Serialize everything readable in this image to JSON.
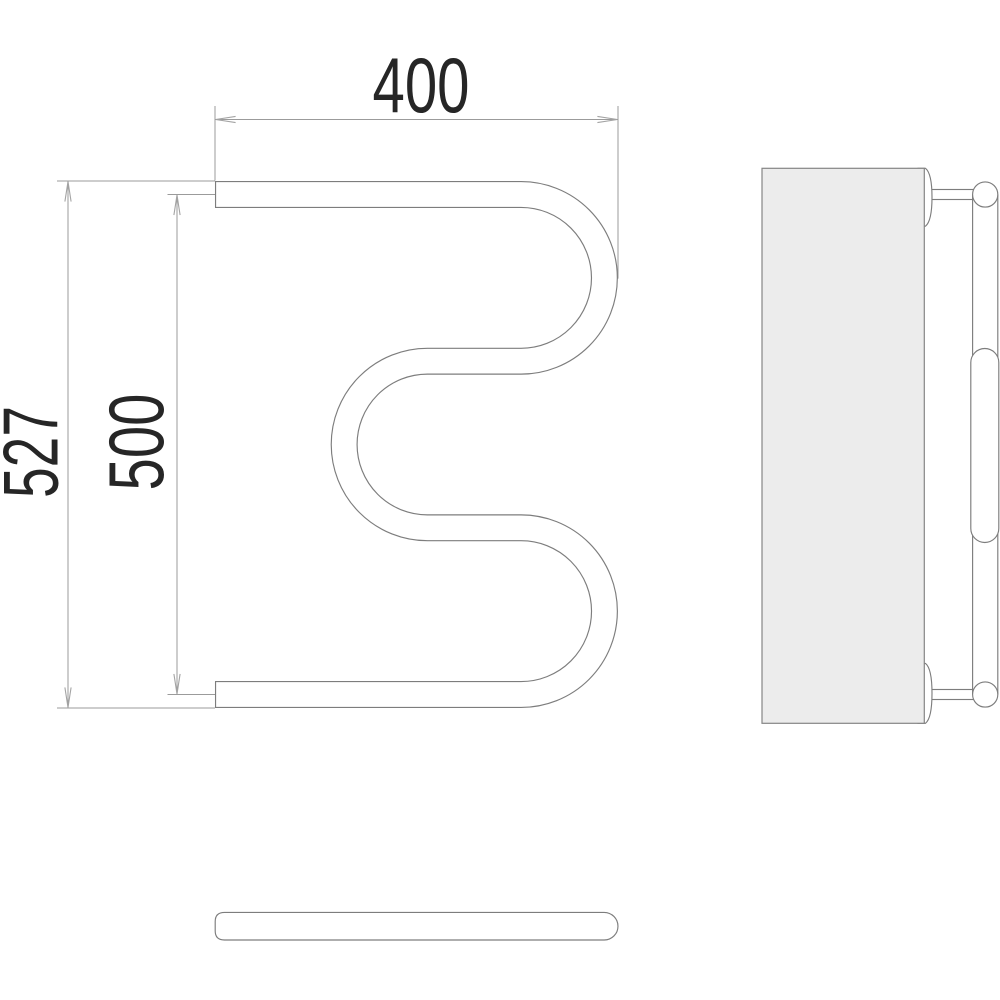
{
  "drawing": {
    "dimensions": {
      "overall_width": "400",
      "overall_height": "527",
      "tube_center_height": "500"
    },
    "colors": {
      "background": "#ffffff",
      "object_line": "#7d7d7d",
      "dimension_line": "#9b9b9b",
      "dimension_arrow": "#a3a3a3",
      "dimension_text": "#262626",
      "side_panel_fill": "#ececec"
    }
  }
}
